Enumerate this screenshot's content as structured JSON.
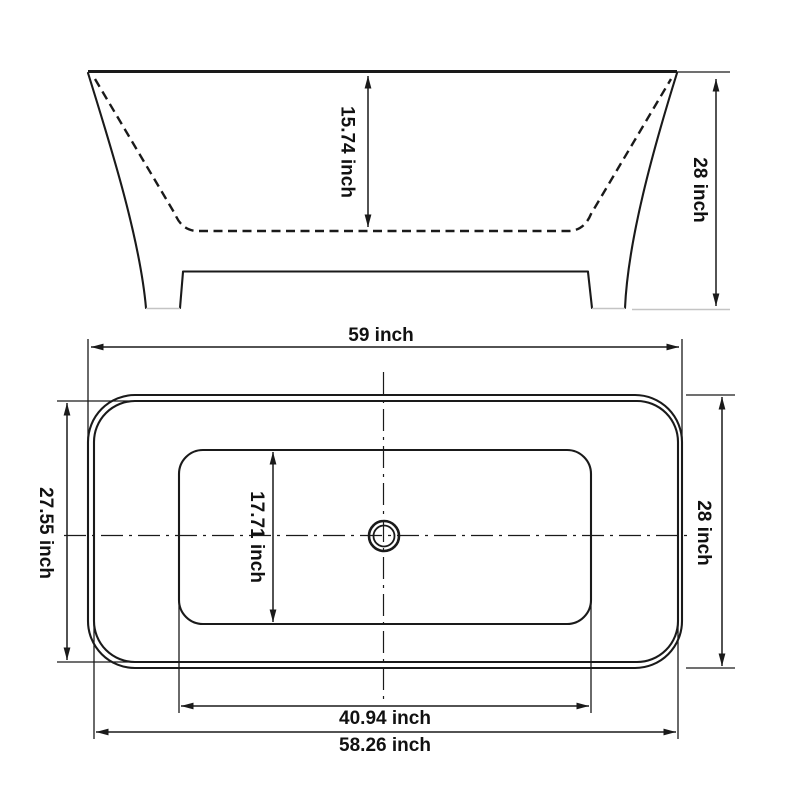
{
  "page": {
    "background": "#ffffff"
  },
  "diagram": {
    "kind": "bathtub-technical-drawing",
    "line_color": "#1a1a1a",
    "faint_line_color": "#c4c4c4",
    "unit": "inch"
  },
  "side_view": {
    "basin_depth_label": "15.74 inch",
    "overall_height_label": "28 inch"
  },
  "top_view": {
    "overall_length_label": "59 inch",
    "rim_inner_width_label": "27.55 inch",
    "overall_width_label": "28 inch",
    "basin_floor_width_label": "17.71 inch",
    "basin_floor_length_label": "40.94 inch",
    "rim_inner_length_label": "58.26 inch"
  }
}
